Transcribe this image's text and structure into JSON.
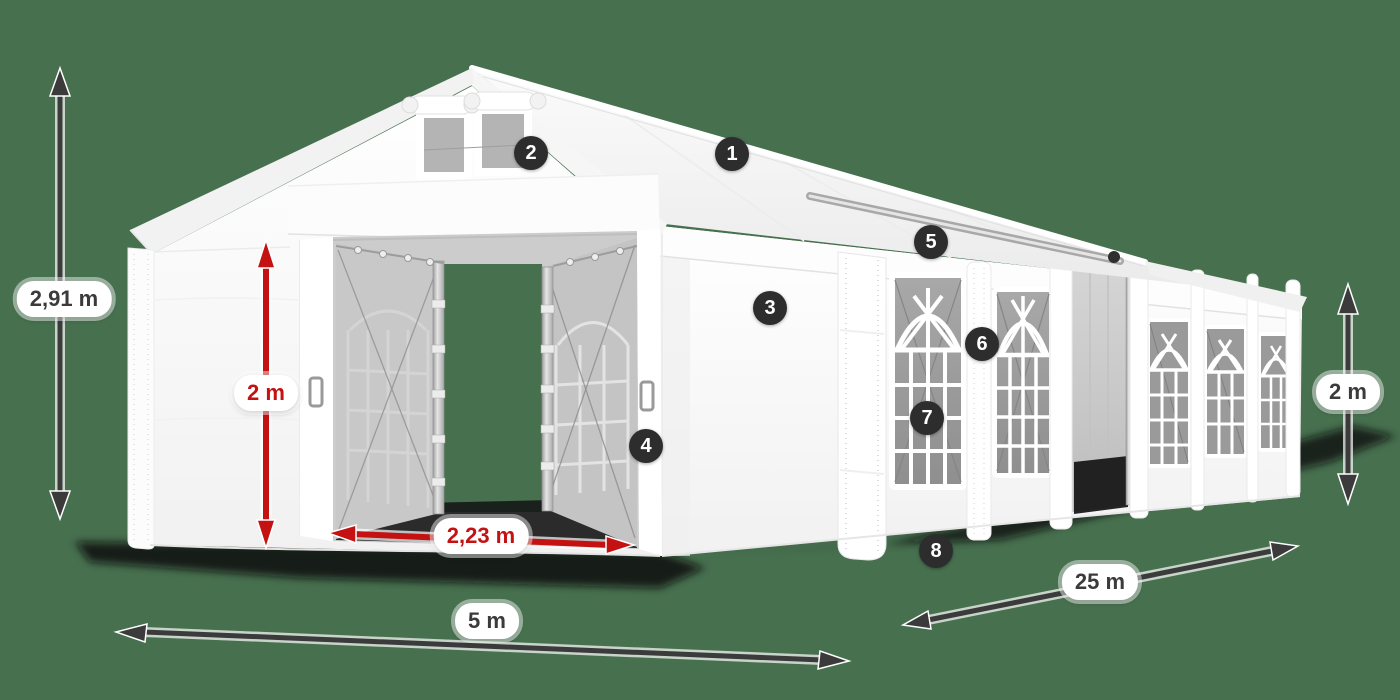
{
  "diagram": {
    "background_color": "#47704F",
    "colors": {
      "dimension_dark": "#3B3B3B",
      "dimension_red": "#C41212",
      "badge_background": "#2D2D2D",
      "badge_text": "#FFFFFF",
      "label_background": "#FFFFFF",
      "tent_white": "#FFFFFF"
    },
    "dimensions": {
      "total_height": "2,91 m",
      "door_height": "2 m",
      "door_width": "2,23 m",
      "front_width": "5 m",
      "side_length": "25 m",
      "side_height": "2 m"
    },
    "callouts": [
      {
        "number": "1"
      },
      {
        "number": "2"
      },
      {
        "number": "3"
      },
      {
        "number": "4"
      },
      {
        "number": "5"
      },
      {
        "number": "6"
      },
      {
        "number": "7"
      },
      {
        "number": "8"
      }
    ]
  }
}
